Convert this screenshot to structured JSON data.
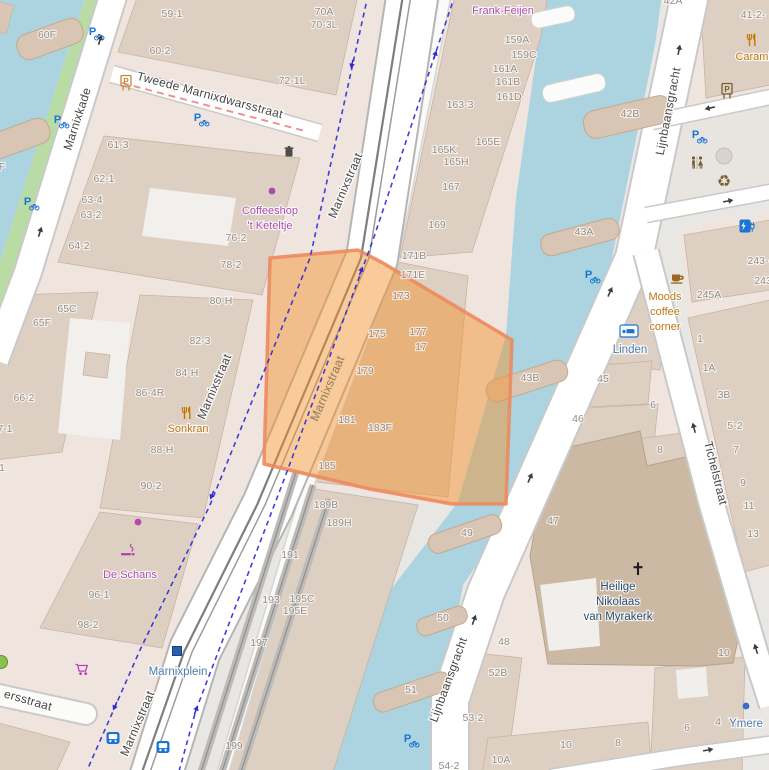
{
  "map": {
    "palette": {
      "background": "#e9e7e4",
      "landuse": "#f0e5de",
      "building": "#decfc3",
      "church_building": "#cbb9a4",
      "water": "#abd4e0",
      "grass": "#b9dca4",
      "road_fill": "#ffffff",
      "road_casing": "#c9c9c9",
      "selection_fill": "#f2932d",
      "selection_border": "#ec8a60",
      "cycle_route": "#2b2bd5",
      "restricted_dash": "#ef8f8f",
      "tram_track": "#7e7e7e",
      "housenumber_text": "#968d83",
      "street_text": "#464646",
      "water_poi_text": "#4c7cb0",
      "amenity_text": "#bf7612",
      "shop_text": "#ae4cae"
    },
    "labels": [
      {
        "t": "Marnixkade",
        "x": 81,
        "y": 120,
        "r": -72,
        "c": "st",
        "s": 13,
        "n": "street-label-marnixkade"
      },
      {
        "t": "Tweede Marnixdwarsstraat",
        "x": 209,
        "y": 99,
        "r": 15,
        "c": "st",
        "s": 12,
        "n": "street-label-tweede-marnixdwarsstraat"
      },
      {
        "t": "Marnixstraat",
        "x": 349,
        "y": 187,
        "r": -67,
        "c": "st",
        "s": 13,
        "n": "street-label-marnixstraat-top"
      },
      {
        "t": "Marnixstraat",
        "x": 218,
        "y": 388,
        "r": -67,
        "c": "st",
        "s": 12,
        "n": "street-label-marnixstraat-west"
      },
      {
        "t": "Marnixstraat",
        "x": 331,
        "y": 390,
        "r": -67,
        "c": "sto",
        "s": 12,
        "n": "street-label-marnixstraat-selection"
      },
      {
        "t": "Marnixstraat",
        "x": 141,
        "y": 725,
        "r": -67,
        "c": "st",
        "s": 13,
        "n": "street-label-marnixstraat-bottom"
      },
      {
        "t": "Lijnbaansgracht",
        "x": 672,
        "y": 112,
        "r": -79,
        "c": "st",
        "s": 12,
        "n": "street-label-lijnbaansgracht-top"
      },
      {
        "t": "Lijnbaansgracht",
        "x": 452,
        "y": 681,
        "r": -70,
        "c": "st",
        "s": 12,
        "n": "street-label-lijnbaansgracht-bottom"
      },
      {
        "t": "Tichelstraat",
        "x": 712,
        "y": 474,
        "r": 76,
        "c": "st",
        "s": 12,
        "n": "street-label-tichelstraat"
      },
      {
        "t": "ersstraat",
        "x": 27,
        "y": 704,
        "r": 16,
        "c": "st",
        "s": 13,
        "n": "street-label-ersstraat"
      },
      {
        "t": "Marnixplein",
        "x": 178,
        "y": 675,
        "c": "wt",
        "s": 12,
        "n": "tram-stop-label-marnixplein"
      },
      {
        "t": "Linden",
        "x": 630,
        "y": 353,
        "c": "wt",
        "n": "hotel-label-linden"
      },
      {
        "t": "Ymere",
        "x": 746,
        "y": 727,
        "c": "wt",
        "n": "office-label-ymere"
      },
      {
        "t": "Heilige",
        "x": 618,
        "y": 590,
        "c": "ch",
        "n": "church-label-line1"
      },
      {
        "t": "Nikolaas",
        "x": 618,
        "y": 605,
        "c": "ch",
        "n": "church-label-line2"
      },
      {
        "t": "van Myrakerk",
        "x": 618,
        "y": 620,
        "c": "ch",
        "n": "church-label-line3"
      },
      {
        "t": "Frank-Feijen",
        "x": 503,
        "y": 14,
        "c": "mg",
        "n": "shop-label-frank-feijen"
      },
      {
        "t": "Coffeeshop",
        "x": 270,
        "y": 214,
        "c": "mg",
        "n": "shop-label-coffeeshop"
      },
      {
        "t": "'t Keteltje",
        "x": 270,
        "y": 229,
        "c": "mg",
        "n": "shop-label-keteltje"
      },
      {
        "t": "De Schans",
        "x": 130,
        "y": 578,
        "c": "mg",
        "n": "shop-label-de-schans"
      },
      {
        "t": "Sonkran",
        "x": 188,
        "y": 432,
        "c": "poi",
        "n": "restaurant-label-sonkran"
      },
      {
        "t": "Caramb",
        "x": 755,
        "y": 60,
        "c": "poi",
        "n": "restaurant-label-carambola"
      },
      {
        "t": "Moods",
        "x": 665,
        "y": 300,
        "c": "poi",
        "n": "cafe-label-moods-1"
      },
      {
        "t": "coffee",
        "x": 665,
        "y": 315,
        "c": "poi",
        "n": "cafe-label-moods-2"
      },
      {
        "t": "corner",
        "x": 665,
        "y": 330,
        "c": "poi",
        "n": "cafe-label-moods-3"
      },
      {
        "t": "60F",
        "x": 47,
        "y": 38
      },
      {
        "t": "F",
        "x": 2,
        "y": 170
      },
      {
        "t": "59-1",
        "x": 172,
        "y": 17
      },
      {
        "t": "60-2",
        "x": 160,
        "y": 54
      },
      {
        "t": "70A",
        "x": 324,
        "y": 15
      },
      {
        "t": "70-3L",
        "x": 324,
        "y": 28
      },
      {
        "t": "72-1L",
        "x": 292,
        "y": 84
      },
      {
        "t": "61-3",
        "x": 118,
        "y": 148
      },
      {
        "t": "62-1",
        "x": 104,
        "y": 182
      },
      {
        "t": "63-4",
        "x": 92,
        "y": 203
      },
      {
        "t": "63-2",
        "x": 91,
        "y": 218
      },
      {
        "t": "64-2",
        "x": 79,
        "y": 249
      },
      {
        "t": "76-2",
        "x": 236,
        "y": 241
      },
      {
        "t": "78-2",
        "x": 231,
        "y": 268
      },
      {
        "t": "80-H",
        "x": 221,
        "y": 304
      },
      {
        "t": "82-3",
        "x": 200,
        "y": 344
      },
      {
        "t": "84-H",
        "x": 187,
        "y": 376
      },
      {
        "t": "86-4R",
        "x": 150,
        "y": 396
      },
      {
        "t": "88-H",
        "x": 162,
        "y": 453
      },
      {
        "t": "90-2",
        "x": 151,
        "y": 489
      },
      {
        "t": "65C",
        "x": 67,
        "y": 312
      },
      {
        "t": "65F",
        "x": 42,
        "y": 326
      },
      {
        "t": "66-2",
        "x": 24,
        "y": 401
      },
      {
        "t": "67-1",
        "x": 2,
        "y": 432
      },
      {
        "t": "1",
        "x": 2,
        "y": 471
      },
      {
        "t": "96-1",
        "x": 99,
        "y": 598
      },
      {
        "t": "98-2",
        "x": 88,
        "y": 628
      },
      {
        "t": "159A",
        "x": 517,
        "y": 43
      },
      {
        "t": "159C",
        "x": 524,
        "y": 58
      },
      {
        "t": "161A",
        "x": 505,
        "y": 72
      },
      {
        "t": "161B",
        "x": 508,
        "y": 85
      },
      {
        "t": "161D",
        "x": 509,
        "y": 100
      },
      {
        "t": "163-3",
        "x": 460,
        "y": 108
      },
      {
        "t": "165K",
        "x": 444,
        "y": 153
      },
      {
        "t": "165H",
        "x": 456,
        "y": 165
      },
      {
        "t": "165E",
        "x": 488,
        "y": 145
      },
      {
        "t": "167",
        "x": 451,
        "y": 190
      },
      {
        "t": "169",
        "x": 437,
        "y": 228
      },
      {
        "t": "171B",
        "x": 414,
        "y": 259
      },
      {
        "t": "171E",
        "x": 413,
        "y": 278
      },
      {
        "t": "173",
        "x": 401,
        "y": 299
      },
      {
        "t": "175",
        "x": 377,
        "y": 337
      },
      {
        "t": "177",
        "x": 418,
        "y": 335
      },
      {
        "t": "17",
        "x": 421,
        "y": 350
      },
      {
        "t": "179",
        "x": 365,
        "y": 374
      },
      {
        "t": "181",
        "x": 347,
        "y": 423
      },
      {
        "t": "183F",
        "x": 380,
        "y": 431
      },
      {
        "t": "185",
        "x": 327,
        "y": 469
      },
      {
        "t": "189B",
        "x": 326,
        "y": 508
      },
      {
        "t": "189H",
        "x": 339,
        "y": 526
      },
      {
        "t": "191",
        "x": 290,
        "y": 558
      },
      {
        "t": "193",
        "x": 271,
        "y": 603
      },
      {
        "t": "195C",
        "x": 302,
        "y": 602
      },
      {
        "t": "195E",
        "x": 295,
        "y": 614
      },
      {
        "t": "197",
        "x": 259,
        "y": 646
      },
      {
        "t": "199",
        "x": 234,
        "y": 749
      },
      {
        "t": "42A",
        "x": 673,
        "y": 4
      },
      {
        "t": "42B",
        "x": 630,
        "y": 117
      },
      {
        "t": "43A",
        "x": 584,
        "y": 235
      },
      {
        "t": "43B",
        "x": 530,
        "y": 381
      },
      {
        "t": "49",
        "x": 467,
        "y": 536
      },
      {
        "t": "50",
        "x": 443,
        "y": 621
      },
      {
        "t": "51",
        "x": 411,
        "y": 693
      },
      {
        "t": "41-2-",
        "x": 753,
        "y": 18
      },
      {
        "t": "245A",
        "x": 709,
        "y": 298
      },
      {
        "t": "243-",
        "x": 758,
        "y": 264
      },
      {
        "t": "243",
        "x": 763,
        "y": 284
      },
      {
        "t": "1",
        "x": 700,
        "y": 342
      },
      {
        "t": "1A",
        "x": 709,
        "y": 371
      },
      {
        "t": "3B",
        "x": 724,
        "y": 398
      },
      {
        "t": "5-2",
        "x": 735,
        "y": 429
      },
      {
        "t": "7",
        "x": 736,
        "y": 453
      },
      {
        "t": "9",
        "x": 743,
        "y": 486
      },
      {
        "t": "11",
        "x": 749,
        "y": 509
      },
      {
        "t": "13",
        "x": 753,
        "y": 537
      },
      {
        "t": "45",
        "x": 603,
        "y": 382
      },
      {
        "t": "46",
        "x": 578,
        "y": 422
      },
      {
        "t": "6",
        "x": 653,
        "y": 408
      },
      {
        "t": "8",
        "x": 660,
        "y": 453
      },
      {
        "t": "47",
        "x": 553,
        "y": 524
      },
      {
        "t": "48",
        "x": 504,
        "y": 645
      },
      {
        "t": "52B",
        "x": 498,
        "y": 676
      },
      {
        "t": "53-2",
        "x": 473,
        "y": 721
      },
      {
        "t": "10A",
        "x": 501,
        "y": 763
      },
      {
        "t": "10",
        "x": 566,
        "y": 748
      },
      {
        "t": "8",
        "x": 618,
        "y": 746
      },
      {
        "t": "10",
        "x": 724,
        "y": 656
      },
      {
        "t": "6",
        "x": 687,
        "y": 731
      },
      {
        "t": "4",
        "x": 718,
        "y": 725
      },
      {
        "t": "54-2",
        "x": 449,
        "y": 769
      }
    ],
    "icons": [
      {
        "n": "bicycle-parking-icon",
        "sym": "bikep",
        "x": 95,
        "y": 32,
        "col": "#1a74d2"
      },
      {
        "n": "bicycle-parking-icon",
        "sym": "bikep",
        "x": 60,
        "y": 120,
        "col": "#1a74d2"
      },
      {
        "n": "bicycle-parking-icon",
        "sym": "bikep",
        "x": 30,
        "y": 202,
        "col": "#1a74d2"
      },
      {
        "n": "bicycle-parking-icon",
        "sym": "bikep",
        "x": 200,
        "y": 118,
        "col": "#1a74d2"
      },
      {
        "n": "bicycle-parking-icon",
        "sym": "bikep",
        "x": 698,
        "y": 135,
        "col": "#1a74d2"
      },
      {
        "n": "bicycle-parking-icon",
        "sym": "bikep",
        "x": 591,
        "y": 275,
        "col": "#1a74d2"
      },
      {
        "n": "bicycle-parking-icon",
        "sym": "bikep",
        "x": 410,
        "y": 739,
        "col": "#1a74d2"
      },
      {
        "n": "parking-ticket-machine-icon",
        "sym": "vend",
        "x": 126,
        "y": 83,
        "col": "#c8873a"
      },
      {
        "n": "parking-ticket-machine-icon",
        "sym": "vend",
        "x": 727,
        "y": 91,
        "col": "#7a6030"
      },
      {
        "n": "waste-basket-icon",
        "sym": "trash",
        "x": 289,
        "y": 152,
        "col": "#4d4d4d"
      },
      {
        "n": "restaurant-icon",
        "sym": "rest",
        "x": 187,
        "y": 413,
        "col": "#c77400"
      },
      {
        "n": "restaurant-icon",
        "sym": "rest",
        "x": 752,
        "y": 40,
        "col": "#c77400"
      },
      {
        "n": "cafe-icon",
        "sym": "cafe",
        "x": 677,
        "y": 278,
        "col": "#9c6a1e"
      },
      {
        "n": "hotel-bed-icon",
        "sym": "bed",
        "x": 629,
        "y": 331,
        "col": "#1a74d2"
      },
      {
        "n": "toilets-icon",
        "sym": "wc",
        "x": 697,
        "y": 163,
        "col": "#7a6030"
      },
      {
        "n": "recycling-icon",
        "sym": "recy",
        "x": 724,
        "y": 181,
        "col": "#7a6030"
      },
      {
        "n": "plaza-circle",
        "sym": "gcirc",
        "x": 724,
        "y": 156,
        "col": "#d8d3cd"
      },
      {
        "n": "charging-station-icon",
        "sym": "chg",
        "x": 747,
        "y": 226,
        "col": "#1a74d2"
      },
      {
        "n": "bus-stop-icon",
        "sym": "bus",
        "x": 113,
        "y": 738,
        "col": "#1a74d2"
      },
      {
        "n": "bus-stop-icon",
        "sym": "bus",
        "x": 163,
        "y": 747,
        "col": "#1a74d2"
      },
      {
        "n": "tram-stop-icon",
        "sym": "tram",
        "x": 177,
        "y": 651,
        "col": "#2a5ea8"
      },
      {
        "n": "smoking-shop-icon",
        "sym": "smoke",
        "x": 128,
        "y": 552,
        "col": "#ae4cae"
      },
      {
        "n": "supermarket-cart-icon",
        "sym": "cart",
        "x": 82,
        "y": 669,
        "col": "#bf3ebf"
      },
      {
        "n": "christian-cross-icon",
        "sym": "cross",
        "x": 638,
        "y": 571,
        "col": "#1d1d1d"
      },
      {
        "n": "shop-dot-icon",
        "sym": "dot",
        "x": 272,
        "y": 191,
        "col": "#ae4cae"
      },
      {
        "n": "shop-dot-icon",
        "sym": "dot",
        "x": 138,
        "y": 522,
        "col": "#ae4cae"
      },
      {
        "n": "office-dot-icon",
        "sym": "dot",
        "x": 746,
        "y": 706,
        "col": "#3a6cc8"
      },
      {
        "n": "tree-icon",
        "sym": "gdot",
        "x": 1,
        "y": 662,
        "col": "#8cc152"
      },
      {
        "n": "oneway-arrow-icon",
        "sym": "arrow",
        "x": 100,
        "y": 40,
        "r": 17,
        "col": "#3d3d3d"
      },
      {
        "n": "oneway-arrow-icon",
        "sym": "arrow",
        "x": 40,
        "y": 232,
        "r": 17,
        "col": "#3d3d3d"
      },
      {
        "n": "oneway-arrow-icon",
        "sym": "arrow",
        "x": 679,
        "y": 50,
        "r": 11,
        "col": "#3d3d3d"
      },
      {
        "n": "oneway-arrow-icon",
        "sym": "arrow",
        "x": 610,
        "y": 292,
        "r": 24,
        "col": "#3d3d3d"
      },
      {
        "n": "oneway-arrow-icon",
        "sym": "arrow",
        "x": 530,
        "y": 478,
        "r": 24,
        "col": "#3d3d3d"
      },
      {
        "n": "oneway-arrow-icon",
        "sym": "arrow",
        "x": 474,
        "y": 620,
        "r": 19,
        "col": "#3d3d3d"
      },
      {
        "n": "oneway-arrow-icon",
        "sym": "arrow",
        "x": 694,
        "y": 428,
        "r": -14,
        "col": "#3d3d3d"
      },
      {
        "n": "oneway-arrow-icon",
        "sym": "arrow",
        "x": 756,
        "y": 649,
        "r": -17,
        "col": "#3d3d3d"
      },
      {
        "n": "oneway-arrow-icon",
        "sym": "arrow",
        "x": 708,
        "y": 750,
        "r": 80,
        "col": "#3d3d3d"
      },
      {
        "n": "oneway-arrow-icon",
        "sym": "arrow",
        "x": 710,
        "y": 108,
        "r": -102,
        "col": "#3d3d3d"
      },
      {
        "n": "oneway-arrow-icon",
        "sym": "arrow",
        "x": 728,
        "y": 201,
        "r": 80,
        "col": "#3d3d3d"
      },
      {
        "n": "cycle-route-arrow-icon",
        "sym": "carrow",
        "x": 352,
        "y": 64,
        "r": 193,
        "col": "#2b2bd5"
      },
      {
        "n": "cycle-route-arrow-icon",
        "sym": "carrow",
        "x": 212,
        "y": 495,
        "r": 202,
        "col": "#2b2bd5"
      },
      {
        "n": "cycle-route-arrow-icon",
        "sym": "carrow",
        "x": 115,
        "y": 706,
        "r": 204,
        "col": "#2b2bd5"
      },
      {
        "n": "cycle-route-arrow-icon",
        "sym": "carrow",
        "x": 435,
        "y": 55,
        "r": 19,
        "col": "#2b2bd5"
      },
      {
        "n": "cycle-route-arrow-icon",
        "sym": "carrow",
        "x": 361,
        "y": 271,
        "r": 20,
        "col": "#2b2bd5"
      },
      {
        "n": "cycle-route-arrow-icon",
        "sym": "carrow",
        "x": 196,
        "y": 710,
        "r": 21,
        "col": "#2b2bd5"
      }
    ]
  }
}
